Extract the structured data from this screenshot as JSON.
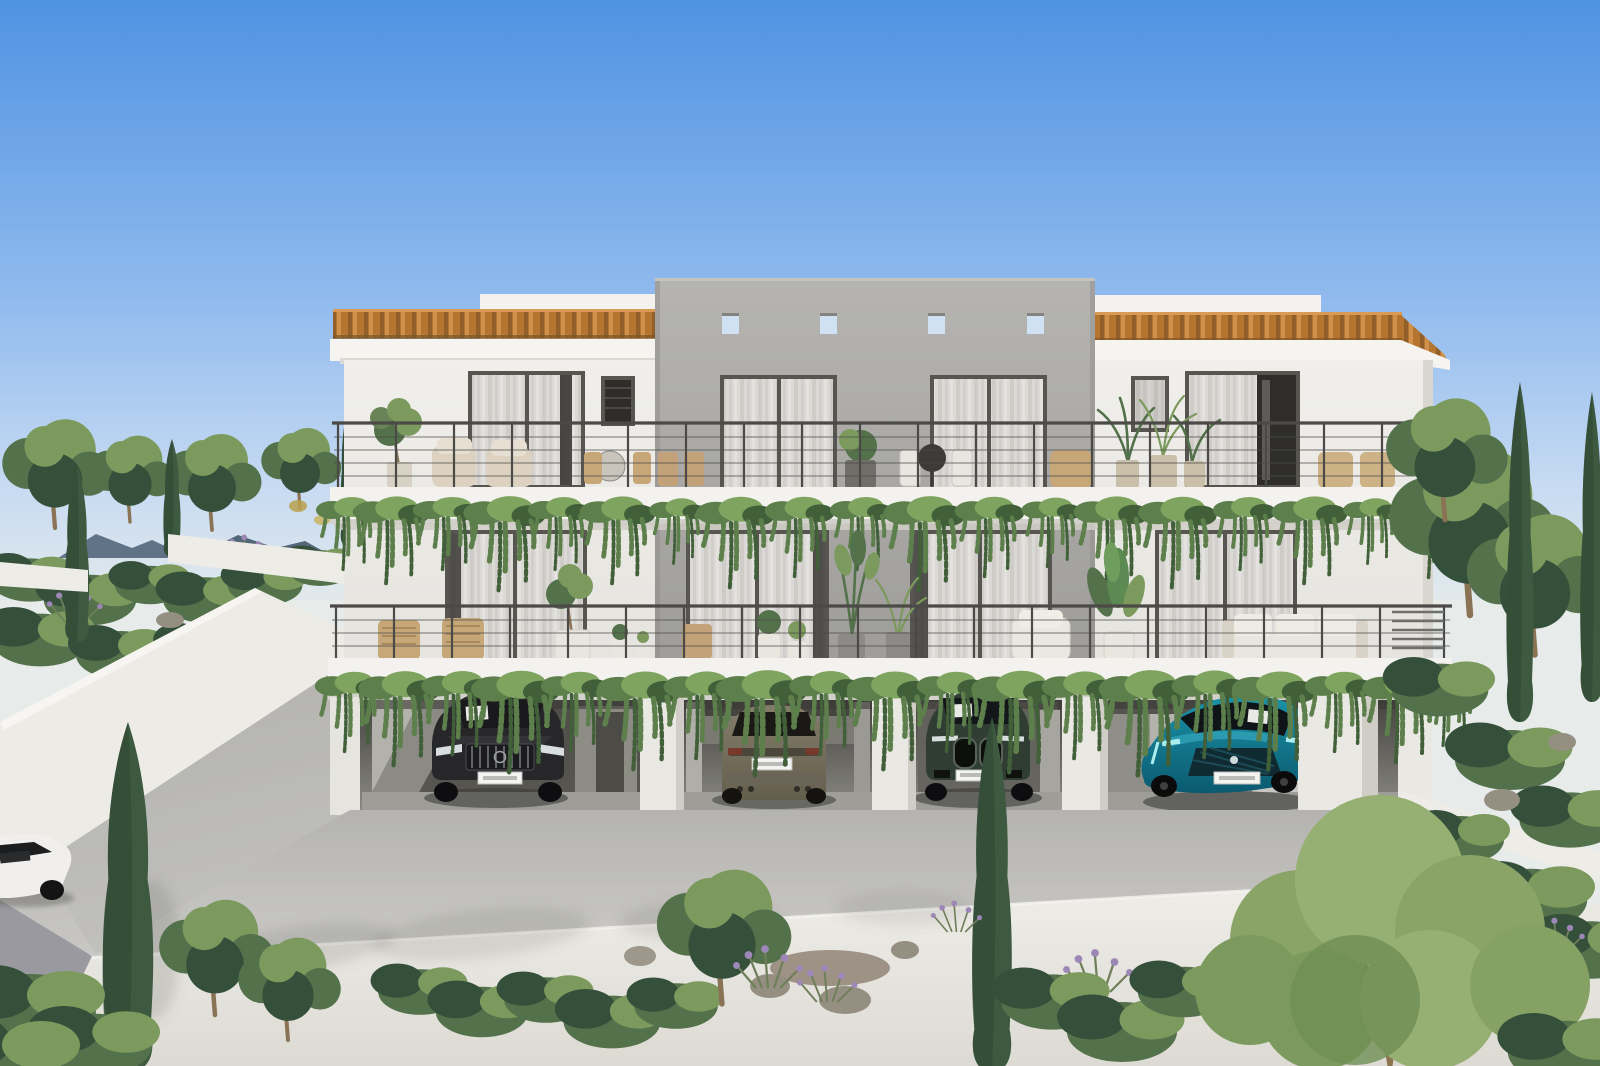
{
  "meta": {
    "description": "Photorealistic daytime exterior render of a modern two-storey Mediterranean apartment building with terracotta tile roof edges, a taller gray concrete central tower pierced by four small square openings, two full-width balconies draped with trailing ivy and furnished with chairs and potted plants, glass sliding doors with sheer curtains, and an open carport underneath holding four cars; a concrete ramp with white retaining walls descends to the left, hillside shrubs and cypress trees frame both sides, and dense bushes, lavender and rocks fill the foreground."
  },
  "palette": {
    "sky_top": "#4f92e2",
    "sky_mid": "#93bcee",
    "sky_low": "#c6daf2",
    "sky_horizon": "#e7eceb",
    "mountain": "#56697e",
    "facade_white": "#f0efeb",
    "facade_shade": "#e4e2dd",
    "parapet_white": "#f3f2ef",
    "concrete_gray_top": "#b5b4b1",
    "concrete_gray_bottom": "#9c9b98",
    "roof_tile": "#b5742f",
    "roof_tile_light": "#d99a55",
    "roof_tile_dark": "#7e5526",
    "fascia_white": "#f5f4f1",
    "slab_white": "#f3f2ee",
    "railing_gray": "#4b4a47",
    "curtain_light": "#dbd9d5",
    "curtain_stripe": "#cfccc8",
    "frame_dark": "#56554f",
    "glass_dark": "#2e2d2a",
    "ivy_light": "#7fa45f",
    "ivy_mid": "#5c7f4b",
    "ivy_dark": "#41603a",
    "foliage_light": "#7c9a5d",
    "foliage_mid": "#53714a",
    "foliage_dark": "#35503a",
    "cypress_green": "#3d5a40",
    "cypress_dark": "#2e4634",
    "deck_gray": "#b4b3af",
    "deck_light": "#cccbc7",
    "carport_dark": "#44433f",
    "carport_floor": "#96958f",
    "column_white": "#eae8e3",
    "column_shade": "#d0cdc6",
    "wall_white": "#eeece7",
    "lavender": "#9d87b6",
    "rock_gray": "#958f82",
    "trunk_brown": "#8a7354",
    "pot_beige": "#cabfa8",
    "pot_white": "#e9e6df",
    "wood_tan": "#c7a778",
    "cushion_beige": "#ddd2c1",
    "car_black": "#27272a",
    "car_olive": "#7b7461",
    "car_green": "#2f3d33",
    "car_teal": "#1587a0",
    "car_teal_dark": "#0b5a70",
    "car_white": "#f0efed",
    "headlight": "#d8dde0",
    "drl_teal": "#aaeef0",
    "plate_white": "#f4f4f2"
  },
  "building": {
    "storeys": 2,
    "balcony_levels": 2,
    "central_tower_square_openings": 4,
    "upper_floor_glass_doors": 5,
    "lower_floor_glass_doors": 4,
    "roof_style": "terracotta-tile-edged flat roof with raised white parapets",
    "railing_style": "slim dark metal posts with horizontal tension cables",
    "planting": "trailing ivy cascading from both balcony slab edges"
  },
  "carport": {
    "bays": 4,
    "white_columns": 4
  },
  "cars": [
    {
      "id": "car-black-suv",
      "description": "black SUV, front view, bay 1",
      "color": "#27272a"
    },
    {
      "id": "car-olive-suv",
      "description": "olive-bronze SUV, rear view, bay 2",
      "color": "#7b7461"
    },
    {
      "id": "car-green-suv",
      "description": "dark green SUV with twin kidney grille, front view, bay 3",
      "color": "#2f3d33"
    },
    {
      "id": "car-teal-fastback",
      "description": "teal fastback, angled front view, bay 4",
      "color": "#1587a0"
    },
    {
      "id": "car-white-partial",
      "description": "white car partially visible at the left edge on the ramp",
      "color": "#f0efed"
    }
  ],
  "landscape": {
    "left": "concrete access ramp with white retaining walls, hillside shrubs, distant blue ridge, cypress trees",
    "right": "dense hillside trees, cypresses and white terrace walls",
    "foreground": "shrubs, lavender clumps, rocks, two tall cypress trees and leafy trees in front of a sunlit white wall"
  }
}
